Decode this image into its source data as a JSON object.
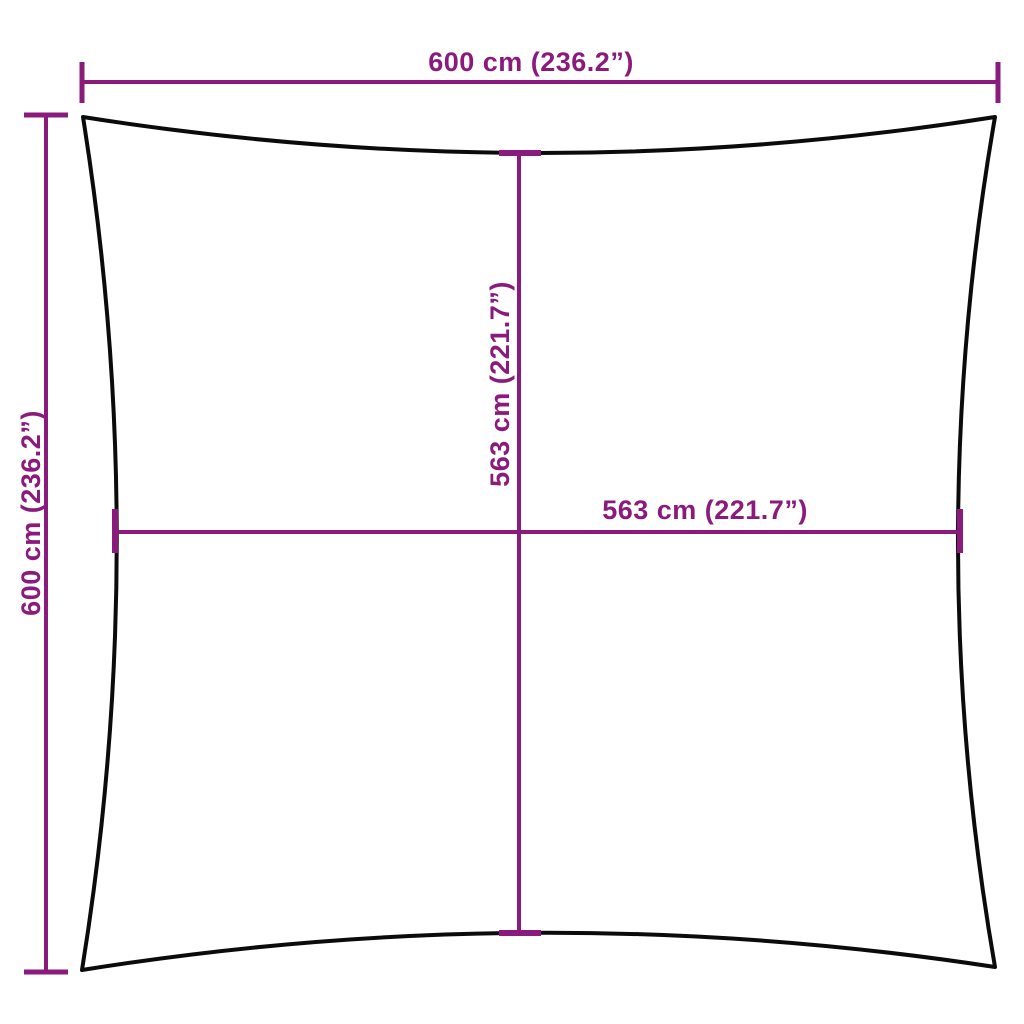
{
  "diagram": {
    "type": "product-dimension-diagram",
    "background_color": "#ffffff",
    "accent_color": "#8B1A7D",
    "outline_color": "#0B0B0B",
    "dimensions": {
      "top": "600 cm (236.2”)",
      "left": "600 cm (236.2”)",
      "inner_vertical": "563 cm (221.7”)",
      "inner_horizontal": "563 cm (221.7”)"
    }
  }
}
